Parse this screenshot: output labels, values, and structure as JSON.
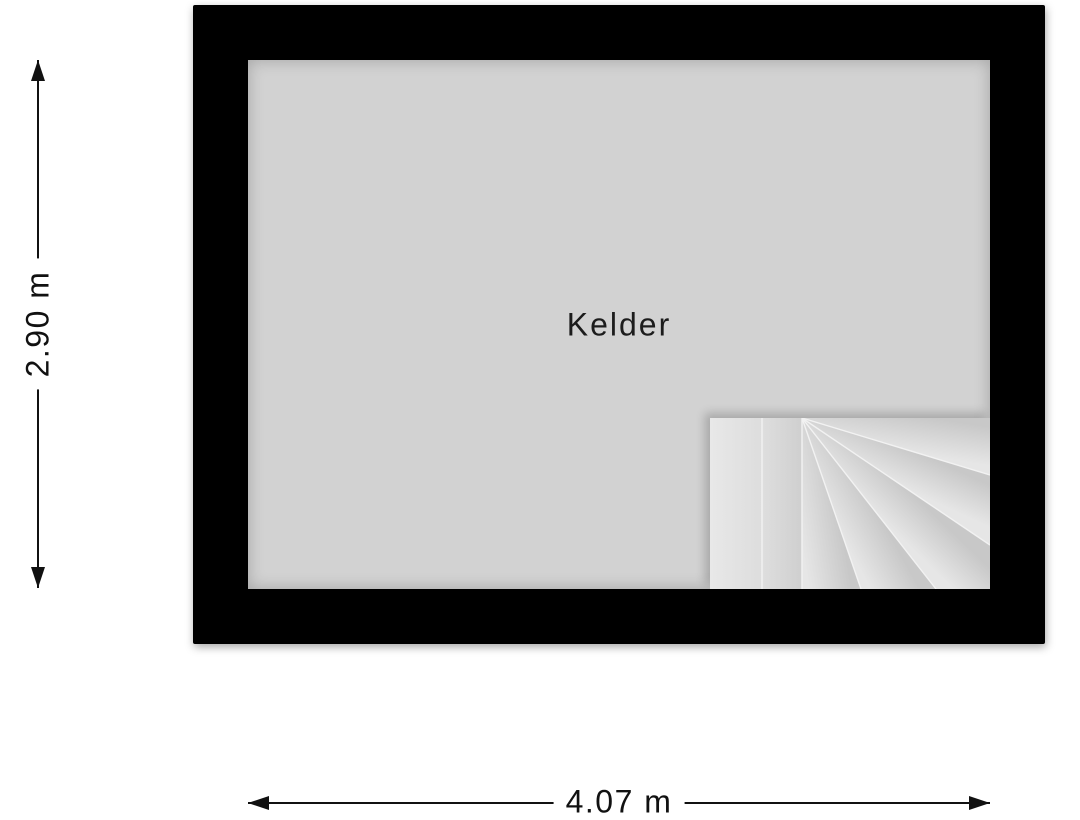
{
  "plan": {
    "room_label": "Kelder",
    "vertical_dimension": "2.90 m",
    "horizontal_dimension": "4.07 m"
  },
  "colors": {
    "wall": "#000000",
    "floor": "#d2d2d2",
    "stair_tread_light": "#e6e6e6",
    "stair_tread_dark": "#c8c8c8",
    "dimension": "#111111",
    "background": "#ffffff"
  },
  "icons": {
    "arrow_up": "css-triangle-up",
    "arrow_down": "css-triangle-down",
    "arrow_left": "css-triangle-left",
    "arrow_right": "css-triangle-right",
    "staircase": "winder-staircase-fan"
  }
}
